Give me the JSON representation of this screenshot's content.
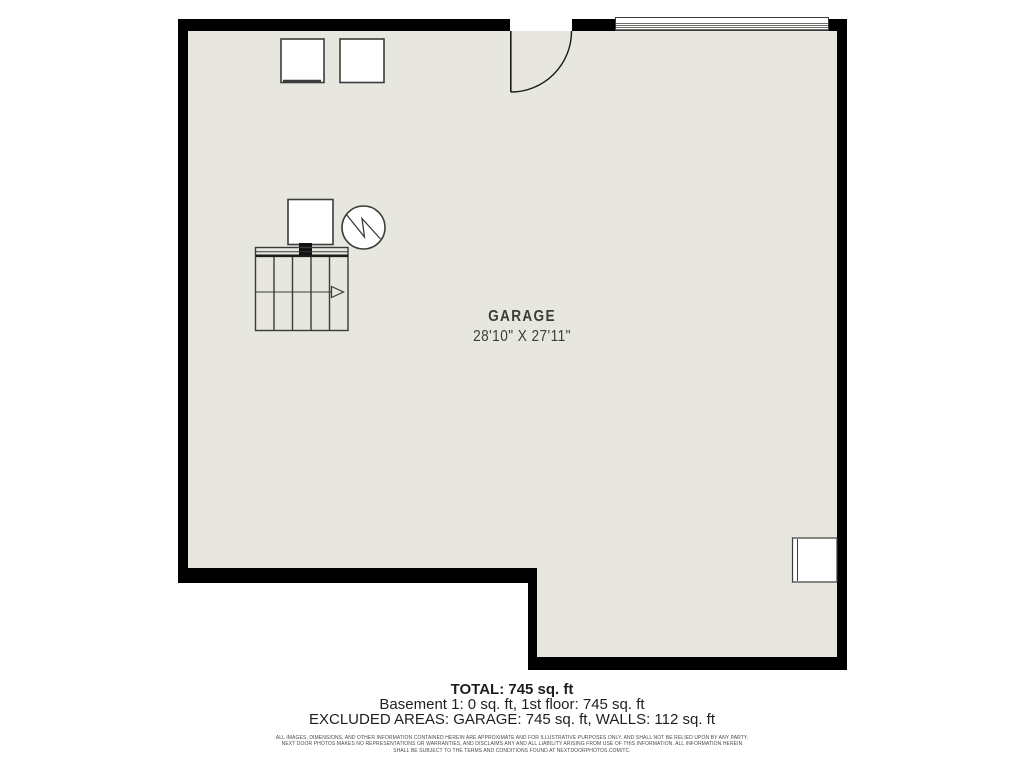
{
  "floorplan": {
    "room": {
      "label": "GARAGE",
      "dimensions": "28'10\" X 27'11\""
    },
    "colors": {
      "wall": "#000000",
      "floor": "#e8e7df",
      "line": "#3b3b39"
    },
    "symbols": {
      "entry_door": "quarter-circle door swing",
      "garage_door": "horizontal slat lines",
      "washer": "square",
      "dryer": "square",
      "furnace": "square with duct stub",
      "water_heater": "circle with zigzag",
      "staircase": "treads with direction arrow",
      "storage": "wall-mounted rectangle"
    }
  },
  "summary": {
    "total": "TOTAL: 745 sq. ft",
    "floors": "Basement 1: 0 sq. ft, 1st floor: 745 sq. ft",
    "excluded": "EXCLUDED AREAS: GARAGE: 745 sq. ft, WALLS: 112 sq. ft"
  },
  "disclaimer": {
    "line1": "ALL IMAGES, DIMENSIONS, AND OTHER INFORMATION CONTAINED HEREIN ARE APPROXIMATE AND FOR ILLUSTRATIVE PURPOSES ONLY, AND SHALL NOT BE RELIED UPON BY ANY PARTY.",
    "line2": "NEXT DOOR PHOTOS MAKES NO REPRESENTATIONS OR WARRANTIES, AND DISCLAIMS ANY AND ALL LIABILITY ARISING FROM USE OF THIS INFORMATION. ALL INFORMATION HEREIN",
    "line3": "SHALL BE SUBJECT TO THE TERMS AND CONDITIONS FOUND AT NEXTDOORPHOTOS.COM/TC."
  }
}
